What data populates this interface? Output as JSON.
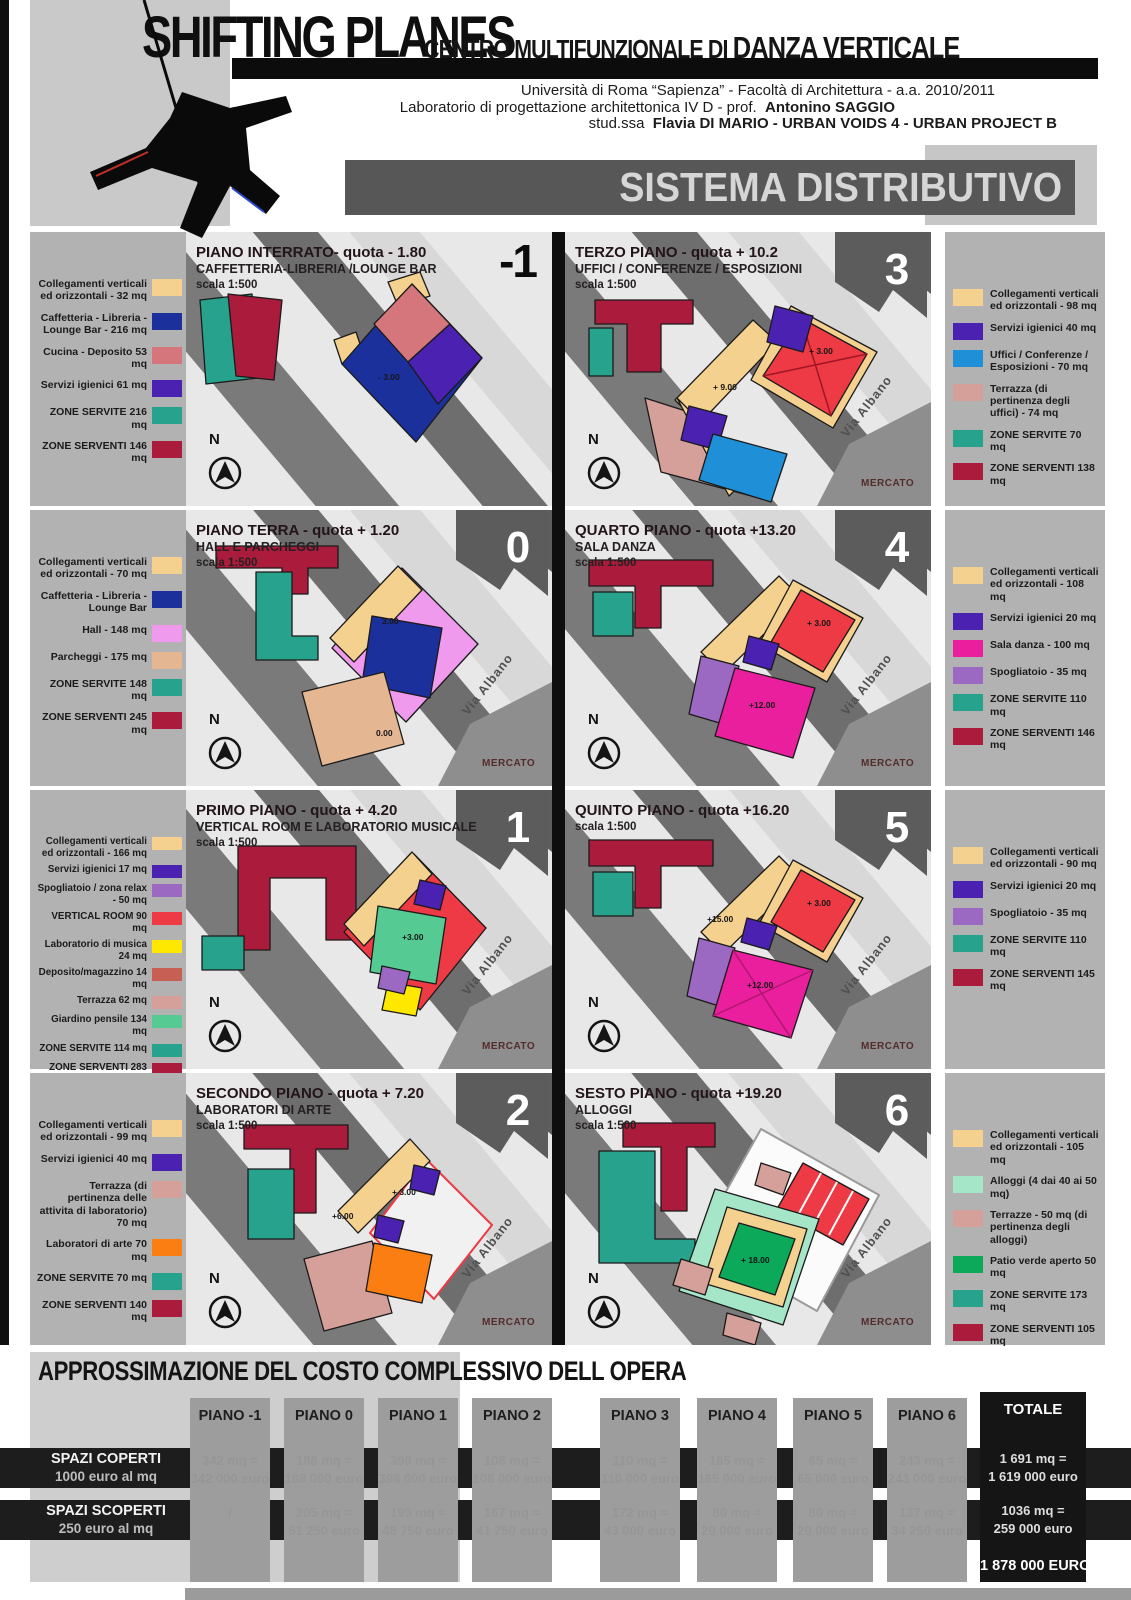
{
  "palette": {
    "cream": "#f5d18f",
    "blue": "#1c309b",
    "salmon": "#d4767c",
    "violet_deep": "#4a21b0",
    "teal": "#27a28c",
    "crimson": "#ab1b3c",
    "uffici_blue": "#1f90d8",
    "terrazza_pink": "#d5a09a",
    "hall_pink": "#f09aee",
    "parcheggi_tan": "#e5b692",
    "red": "#ed3a44",
    "yellow": "#ffe800",
    "brick": "#c75f55",
    "garden_green": "#55ca92",
    "magenta": "#ea1f9e",
    "spogliatoio_purple": "#9c69c2",
    "orange": "#fb7e12",
    "mint": "#a5e6c9",
    "patio_green": "#0ca95a"
  },
  "header": {
    "title": "SHIFTING PLANES",
    "subtitle_light": "CENTRO MULTIFUNZIONALE DI ",
    "subtitle_strong": "DANZA VERTICALE",
    "credit1": "Università di Roma “Sapienza”  -  Facoltà di Architettura  -  a.a. 2010/2011",
    "credit2_text": "Laboratorio di progettazione architettonica IV D   -   prof.",
    "credit2_strong": "Antonino SAGGIO",
    "credit3_text": "stud.ssa",
    "credit3_strong": "Flavia DI MARIO   -   URBAN VOIDS 4  -  URBAN PROJECT B",
    "sheet_number": "6",
    "banner": "SISTEMA DISTRIBUTIVO"
  },
  "panels": [
    {
      "id": "m1",
      "number": "-1",
      "title": "PIANO INTERRATO- quota - 1.80",
      "subtitle": "CAFFETTERIA-LIBRERIA /LOUNGE BAR",
      "scale": "scala 1:500",
      "north": "N",
      "street": "",
      "mercato": "",
      "quotas": [
        "- 3.00"
      ],
      "legend": [
        {
          "label": "Collegamenti verticali ed orizzontali - 32 mq",
          "color": "cream"
        },
        {
          "label": "Caffetteria - Libreria - Lounge Bar - 216 mq",
          "color": "blue"
        },
        {
          "label": "Cucina - Deposito 53 mq",
          "color": "salmon"
        },
        {
          "label": "Servizi igienici 61 mq",
          "color": "violet_deep"
        },
        {
          "label": "ZONE SERVITE 216 mq",
          "color": "teal"
        },
        {
          "label": "ZONE SERVENTI 146 mq",
          "color": "crimson"
        }
      ]
    },
    {
      "id": "p0",
      "number": "0",
      "title": "PIANO TERRA - quota + 1.20",
      "subtitle": "HALL E PARCHEGGI",
      "scale": "scala 1:500",
      "north": "N",
      "street": "Via Albano",
      "mercato": "MERCATO",
      "quotas": [
        "3.00",
        "0.00"
      ],
      "legend": [
        {
          "label": "Collegamenti verticali ed orizzontali - 70 mq",
          "color": "cream"
        },
        {
          "label": "Caffetteria - Libreria - Lounge Bar",
          "color": "blue"
        },
        {
          "label": "Hall - 148 mq",
          "color": "hall_pink"
        },
        {
          "label": "Parcheggi - 175 mq",
          "color": "parcheggi_tan"
        },
        {
          "label": "ZONE SERVITE 148 mq",
          "color": "teal"
        },
        {
          "label": "ZONE SERVENTI 245 mq",
          "color": "crimson"
        }
      ]
    },
    {
      "id": "p1",
      "number": "1",
      "title": "PRIMO PIANO - quota + 4.20",
      "subtitle": "VERTICAL ROOM E LABORATORIO MUSICALE",
      "scale": "scala 1:500",
      "north": "N",
      "street": "Via Albano",
      "mercato": "MERCATO",
      "quotas": [
        "+3.00"
      ],
      "legend": [
        {
          "label": "Collegamenti verticali ed orizzontali - 166 mq",
          "color": "cream"
        },
        {
          "label": "Servizi igienici 17 mq",
          "color": "violet_deep"
        },
        {
          "label": "Spogliatoio / zona relax - 50 mq",
          "color": "spogliatoio_purple"
        },
        {
          "label": "VERTICAL ROOM 90 mq",
          "color": "red"
        },
        {
          "label": "Laboratorio di musica 24 mq",
          "color": "yellow"
        },
        {
          "label": "Deposito/magazzino 14 mq",
          "color": "brick"
        },
        {
          "label": "Terrazza 62 mq",
          "color": "terrazza_pink"
        },
        {
          "label": "Giardino pensile 134 mq",
          "color": "garden_green"
        },
        {
          "label": "ZONE SERVITE 114 mq",
          "color": "teal"
        },
        {
          "label": "ZONE SERVENTI 283 mq",
          "color": "crimson"
        }
      ]
    },
    {
      "id": "p2",
      "number": "2",
      "title": "SECONDO PIANO - quota + 7.20",
      "subtitle": "LABORATORI DI ARTE",
      "scale": "scala 1:500",
      "north": "N",
      "street": "Via Albano",
      "mercato": "MERCATO",
      "quotas": [
        "+ 3.00",
        "+6.00"
      ],
      "legend": [
        {
          "label": "Collegamenti verticali ed orizzontali - 99 mq",
          "color": "cream"
        },
        {
          "label": "Servizi igienici 40 mq",
          "color": "violet_deep"
        },
        {
          "label": "Terrazza (di pertinenza delle attivita di laboratorio) 70 mq",
          "color": "terrazza_pink"
        },
        {
          "label": "Laboratori di arte 70 mq",
          "color": "orange"
        },
        {
          "label": "ZONE SERVITE 70 mq",
          "color": "teal"
        },
        {
          "label": "ZONE SERVENTI 140 mq",
          "color": "crimson"
        }
      ]
    },
    {
      "id": "p3",
      "number": "3",
      "title": "TERZO PIANO - quota + 10.2",
      "subtitle": "UFFICI / CONFERENZE / ESPOSIZIONI",
      "scale": "scala 1:500",
      "north": "N",
      "street": "Via Albano",
      "mercato": "MERCATO",
      "quotas": [
        "+ 3.00",
        "+ 9.00"
      ],
      "legend": [
        {
          "label": "Collegamenti verticali ed orizzontali - 98 mq",
          "color": "cream"
        },
        {
          "label": "Servizi igienici 40 mq",
          "color": "violet_deep"
        },
        {
          "label": "Uffici / Conferenze / Esposizioni - 70 mq",
          "color": "uffici_blue"
        },
        {
          "label": "Terrazza (di pertinenza degli uffici) - 74 mq",
          "color": "terrazza_pink"
        },
        {
          "label": "ZONE SERVITE 70 mq",
          "color": "teal"
        },
        {
          "label": "ZONE SERVENTI 138 mq",
          "color": "crimson"
        }
      ]
    },
    {
      "id": "p4",
      "number": "4",
      "title": "QUARTO PIANO - quota +13.20",
      "subtitle": "SALA DANZA",
      "scale": "scala 1:500",
      "north": "N",
      "street": "Via Albano",
      "mercato": "MERCATO",
      "quotas": [
        "+ 3.00",
        "+12.00"
      ],
      "legend": [
        {
          "label": "Collegamenti verticali ed orizzontali - 108 mq",
          "color": "cream"
        },
        {
          "label": "Servizi igienici 20 mq",
          "color": "violet_deep"
        },
        {
          "label": "Sala danza - 100 mq",
          "color": "magenta"
        },
        {
          "label": "Spogliatoio - 35 mq",
          "color": "spogliatoio_purple"
        },
        {
          "label": "ZONE SERVITE 110  mq",
          "color": "teal"
        },
        {
          "label": "ZONE SERVENTI 146  mq",
          "color": "crimson"
        }
      ]
    },
    {
      "id": "p5",
      "number": "5",
      "title": "QUINTO PIANO - quota +16.20",
      "subtitle": "",
      "scale": "scala 1:500",
      "north": "N",
      "street": "Via Albano",
      "mercato": "MERCATO",
      "quotas": [
        "+ 3.00",
        "+15.00",
        "+12.00"
      ],
      "legend": [
        {
          "label": "Collegamenti verticali ed orizzontali - 90 mq",
          "color": "cream"
        },
        {
          "label": "Servizi igienici 20 mq",
          "color": "violet_deep"
        },
        {
          "label": "Spogliatoio - 35 mq",
          "color": "spogliatoio_purple"
        },
        {
          "label": "ZONE SERVITE 110  mq",
          "color": "teal"
        },
        {
          "label": "ZONE SERVENTI 145  mq",
          "color": "crimson"
        }
      ]
    },
    {
      "id": "p6",
      "number": "6",
      "title": "SESTO PIANO - quota +19.20",
      "subtitle": "ALLOGGI",
      "scale": "scala 1:500",
      "north": "N",
      "street": "Via Albano",
      "mercato": "MERCATO",
      "quotas": [
        "+ 18.00"
      ],
      "legend": [
        {
          "label": "Collegamenti verticali ed orizzontali - 105 mq",
          "color": "cream"
        },
        {
          "label": "Alloggi (4 dai 40 ai 50 mq)",
          "color": "mint"
        },
        {
          "label": "Terrazze - 50 mq (di pertinenza degli alloggi)",
          "color": "terrazza_pink"
        },
        {
          "label": "Patio verde aperto 50 mq",
          "color": "patio_green"
        },
        {
          "label": "ZONE SERVITE 173  mq",
          "color": "teal"
        },
        {
          "label": "ZONE SERVENTI 105 mq",
          "color": "crimson"
        }
      ]
    }
  ],
  "cost_table": {
    "title": "APPROSSIMAZIONE DEL COSTO COMPLESSIVO DELL OPERA",
    "columns": [
      "PIANO -1",
      "PIANO 0",
      "PIANO 1",
      "PIANO 2",
      "PIANO 3",
      "PIANO 4",
      "PIANO 5",
      "PIANO 6"
    ],
    "total_column": "TOTALE",
    "rows": [
      {
        "label": "SPAZI COPERTI",
        "sublabel": "1000 euro al mq",
        "values": [
          "342 mq =\n342 000 euro",
          "188 mq =\n188 000 euro",
          "398 mq =\n398 000 euro",
          "108 mq =\n108 000 euro",
          "110 mq =\n110 000 euro",
          "165 mq =\n165 000 euro",
          "65 mq =\n65 000 euro",
          "243 mq =\n243 000 euro"
        ],
        "total": "1 691 mq =\n1 619 000 euro"
      },
      {
        "label": "SPAZI SCOPERTI",
        "sublabel": "250 euro al mq",
        "values": [
          "/",
          "205 mq =\n51 250 euro",
          "195 mq =\n48 750 euro",
          "167 mq =\n41 750 euro",
          "172 mq =\n43 000 euro",
          "80 mq =\n20 000 euro",
          "80 mq =\n20 000 euro",
          "137 mq =\n34 250 euro"
        ],
        "total": "1036 mq =\n259 000 euro"
      }
    ],
    "grand_total": "1 878 000 EURO"
  }
}
